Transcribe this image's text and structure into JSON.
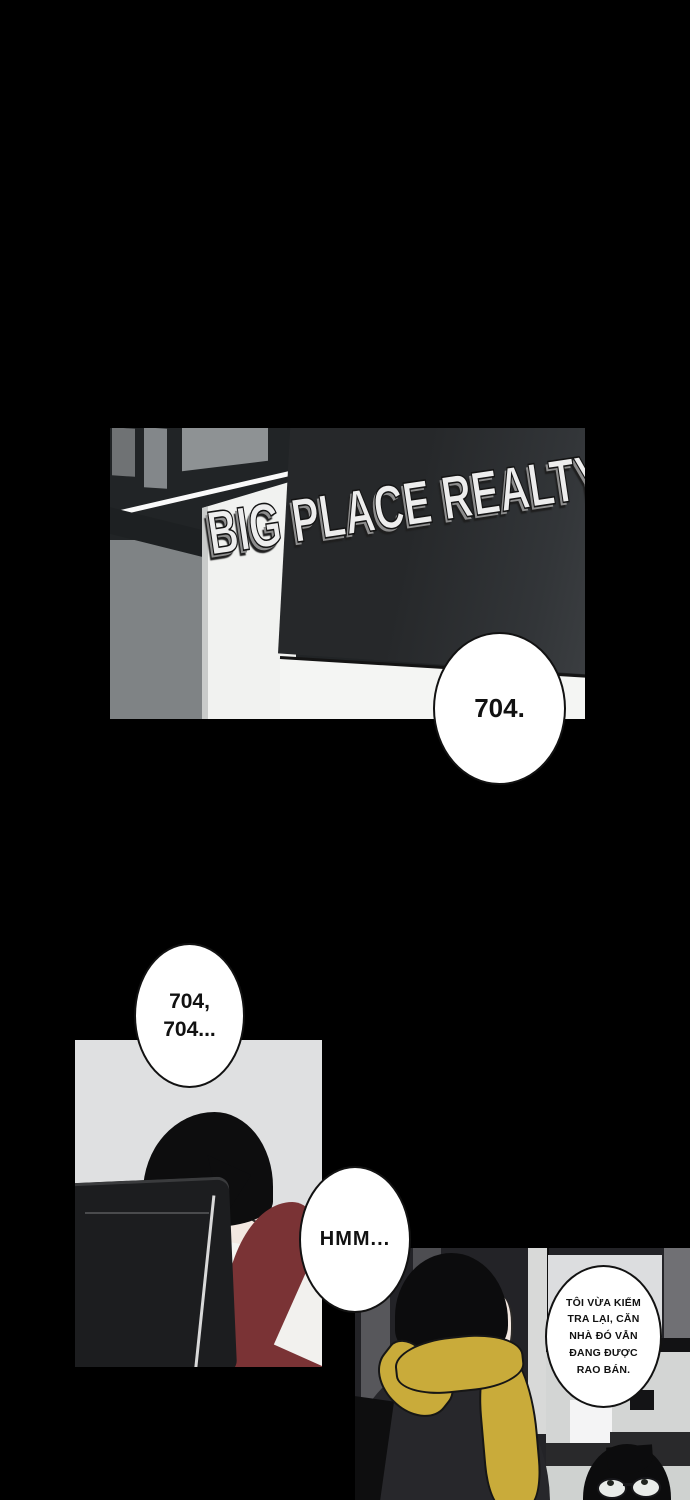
{
  "page": {
    "type": "webtoon-comic-page"
  },
  "panel_storefront": {
    "sign_text": "BIG PLACE REALTY",
    "bubble": {
      "text": "704."
    }
  },
  "panel_office": {
    "bubble_counting": {
      "lines": [
        "704,",
        "704..."
      ]
    },
    "bubble_hmm": {
      "text": "HMM..."
    }
  },
  "panel_agency": {
    "bubble_agent": {
      "lines": [
        "TÔI VỪA KIỂM",
        "TRA LẠI, CĂN",
        "NHÀ ĐÓ VẪN",
        "ĐANG ĐƯỢC",
        "RAO BÁN."
      ],
      "full_text": "TÔI VỪA KIỂM TRA LẠI, CĂN NHÀ ĐÓ VẪN ĐANG ĐƯỢC RAO BÁN."
    }
  },
  "colors": {
    "background": "#000000",
    "signboard": "#26282a",
    "office_panel_bg": "#dfe0e1",
    "cardigan_maroon": "#7a3335",
    "scarf_yellow": "#c9ab3a",
    "agency_wall": "#232327",
    "bubble_fill": "#ffffff",
    "bubble_stroke": "#121212"
  }
}
